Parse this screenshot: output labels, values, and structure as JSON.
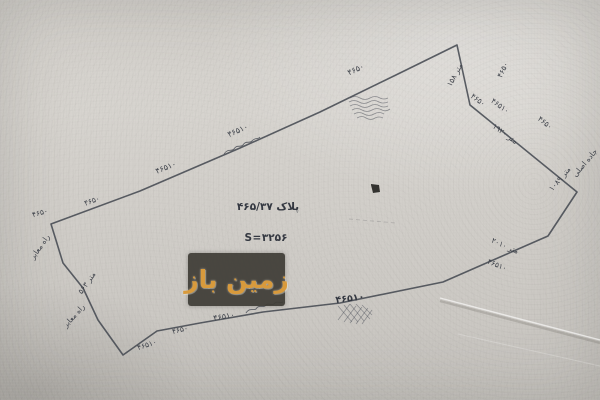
{
  "watermark": {
    "text": "زمین باز",
    "text_color": "#d89a3c",
    "box_color": "#3e3c36"
  },
  "map": {
    "colors": {
      "ink": "#454a52",
      "paper": "#d1cec9"
    },
    "parcel": {
      "plot_label": "پلاک ۴۶۵/۳۷",
      "area_label": "S=۳۲۵۶",
      "outline": [
        [
          51,
          224
        ],
        [
          140,
          191
        ],
        [
          240,
          148
        ],
        [
          320,
          112
        ],
        [
          400,
          73
        ],
        [
          457,
          45
        ],
        [
          470,
          105
        ],
        [
          577,
          192
        ],
        [
          548,
          236
        ],
        [
          443,
          282
        ],
        [
          340,
          303
        ],
        [
          263,
          312
        ],
        [
          200,
          323
        ],
        [
          157,
          331
        ],
        [
          123,
          355
        ],
        [
          98,
          320
        ],
        [
          83,
          288
        ],
        [
          63,
          263
        ],
        [
          51,
          224
        ]
      ]
    },
    "labels": [
      {
        "text": "۴۶۵۰",
        "x": 40,
        "y": 213,
        "rot": -16,
        "size": 7.5
      },
      {
        "text": "۴۶۵۰",
        "x": 92,
        "y": 201,
        "rot": -20,
        "size": 7.5
      },
      {
        "text": "۴۶۵۱۰",
        "x": 166,
        "y": 168,
        "rot": -22,
        "size": 8
      },
      {
        "text": "۴۶۵۱۰",
        "x": 238,
        "y": 131,
        "rot": -24,
        "size": 8
      },
      {
        "text": "۴۶۵۰",
        "x": 356,
        "y": 70,
        "rot": -25,
        "size": 8
      },
      {
        "text": "متر ۱۵۸",
        "x": 455,
        "y": 75,
        "rot": -62,
        "size": 7.5
      },
      {
        "text": "۴۶۵۰",
        "x": 503,
        "y": 70,
        "rot": -65,
        "size": 7.5
      },
      {
        "text": "۴۶۵۰",
        "x": 478,
        "y": 100,
        "rot": 36,
        "size": 7.5
      },
      {
        "text": "۴۶۵۱۰",
        "x": 500,
        "y": 106,
        "rot": 36,
        "size": 7.5
      },
      {
        "text": "۴۶۵۰",
        "x": 545,
        "y": 123,
        "rot": 38,
        "size": 7.5
      },
      {
        "text": "متر ۱۹۲۰",
        "x": 505,
        "y": 134,
        "rot": 36,
        "size": 7.5
      },
      {
        "text": "جاده اصلی",
        "x": 585,
        "y": 163,
        "rot": -50,
        "size": 7.5
      },
      {
        "text": "متر ۱۰۸۹",
        "x": 560,
        "y": 179,
        "rot": -50,
        "size": 7.5
      },
      {
        "text": "متر ۲۰۱۰",
        "x": 505,
        "y": 246,
        "rot": 24,
        "size": 7.5
      },
      {
        "text": "۴۶۵۱۰",
        "x": 497,
        "y": 265,
        "rot": 22,
        "size": 7.5
      },
      {
        "text": "۴۶۵۱۰",
        "x": 350,
        "y": 299,
        "rot": -7,
        "size": 9.5,
        "bold": true
      },
      {
        "text": "۴۶۵۱۰",
        "x": 224,
        "y": 317,
        "rot": -10,
        "size": 8
      },
      {
        "text": "۴۶۵۰",
        "x": 180,
        "y": 330,
        "rot": -14,
        "size": 7.5
      },
      {
        "text": "۴۶۵۱۰",
        "x": 147,
        "y": 345,
        "rot": -18,
        "size": 7.5
      },
      {
        "text": "راه معابر",
        "x": 40,
        "y": 247,
        "rot": -55,
        "size": 7.5
      },
      {
        "text": "متر ۵۶۳",
        "x": 87,
        "y": 283,
        "rot": -55,
        "size": 7.5
      },
      {
        "text": "راه معابر",
        "x": 74,
        "y": 316,
        "rot": -48,
        "size": 7.5
      }
    ]
  }
}
